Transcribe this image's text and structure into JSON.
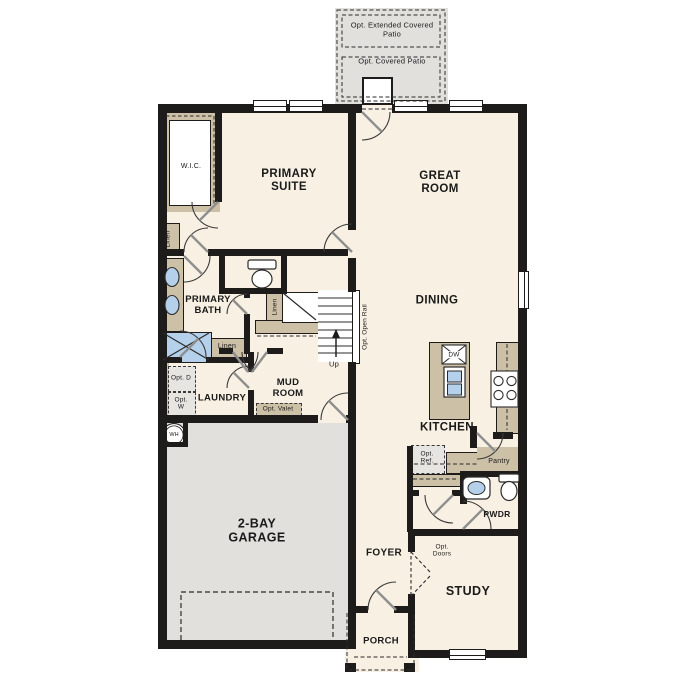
{
  "plan_title": "Single-story floor plan",
  "colors": {
    "wall": "#1e1c1a",
    "floor": "#f8f1e3",
    "patio_garage_fill": "#e1e0dc",
    "cabinet_tan": "#ccc0a7",
    "option_gray": "#e6e5e2",
    "fixture_blue": "#b5d0ea",
    "text": "#1a1a1a"
  },
  "patio": {
    "extended": "Opt. Extended Covered Patio",
    "covered": "Opt. Covered Patio"
  },
  "rooms": {
    "wic": "W.I.C.",
    "primary_suite": "PRIMARY SUITE",
    "great_room": "GREAT ROOM",
    "primary_bath": "PRIMARY BATH",
    "dining": "DINING",
    "mud_room": "MUD ROOM",
    "laundry": "LAUNDRY",
    "garage": "2-BAY GARAGE",
    "kitchen": "KITCHEN",
    "pwdr": "PWDR",
    "foyer": "FOYER",
    "study": "STUDY",
    "porch": "PORCH"
  },
  "closets": {
    "linen_left": "Linen",
    "linen_hall": "Linen",
    "linen_stairs": "Linen",
    "pantry": "Pantry"
  },
  "stairs": {
    "up": "Up",
    "open_rail": "Opt. Open Rail"
  },
  "appliances": {
    "dishwasher": "DW",
    "water_heater": "WH"
  },
  "options": {
    "ref": "Opt. Ref.",
    "valet": "Opt. Valet",
    "dryer": "Opt. D",
    "washer": "Opt. W",
    "doors": "Opt. Doors"
  }
}
